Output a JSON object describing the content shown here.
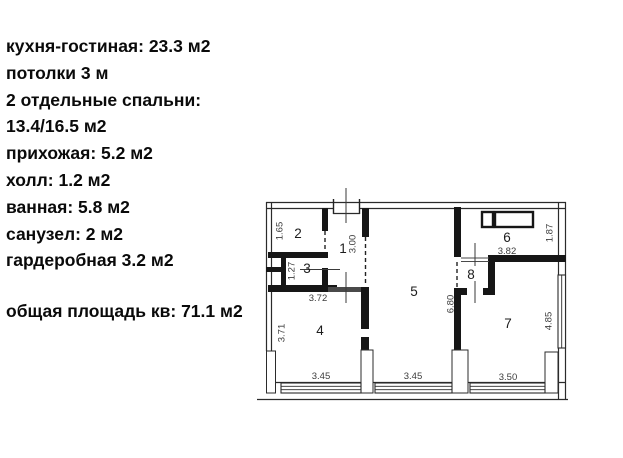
{
  "info_panel": {
    "lines": [
      "кухня-гостиная: 23.3 м2",
      "потолки 3 м",
      "2 отдельные спальни:",
      "13.4/16.5 м2",
      "прихожая: 5.2 м2",
      "холл: 1.2 м2",
      "ванная: 5.8 м2",
      "санузел: 2 м2",
      "гардеробная 3.2 м2"
    ],
    "total": "общая площадь кв: 71.1 м2"
  },
  "floor_plan": {
    "room_labels": {
      "r1": "1",
      "r2": "2",
      "r3": "3",
      "r4": "4",
      "r5": "5",
      "r6": "6",
      "r7": "7",
      "r8": "8"
    },
    "dimensions": {
      "d1_65": "1.65",
      "d1_27": "1.27",
      "d3_00": "3.00",
      "d3_72": "3.72",
      "d3_71": "3.71",
      "d3_45_left": "3.45",
      "d3_45_mid": "3.45",
      "d6_80": "6.80",
      "d3_82": "3.82",
      "d1_87": "1.87",
      "d4_85": "4.85",
      "d3_50": "3.50"
    }
  }
}
